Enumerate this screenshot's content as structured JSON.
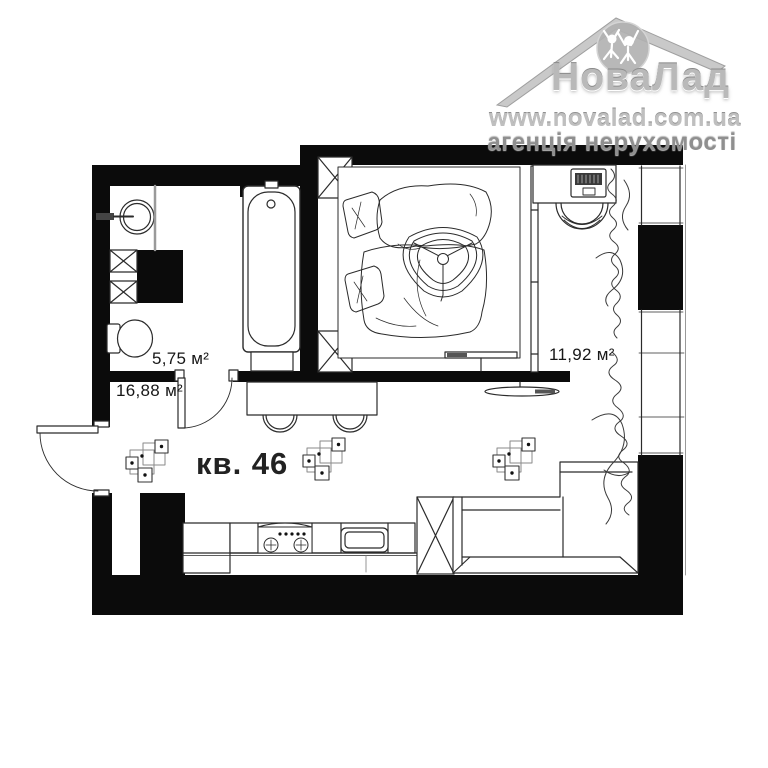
{
  "watermark": {
    "brand": "НоваЛад",
    "website": "www.novalad.com.ua",
    "tagline": "агенція нерухомості"
  },
  "labels": {
    "bathroom_area": "5,75 м²",
    "hall_area": "16,88 м²",
    "room_area": "11,92 м²",
    "apartment_number": "кв. 46"
  },
  "colors": {
    "walls": "#0b0b0b",
    "linework": "#2b2b2b",
    "watermark_silver": "#b9b9b9"
  }
}
